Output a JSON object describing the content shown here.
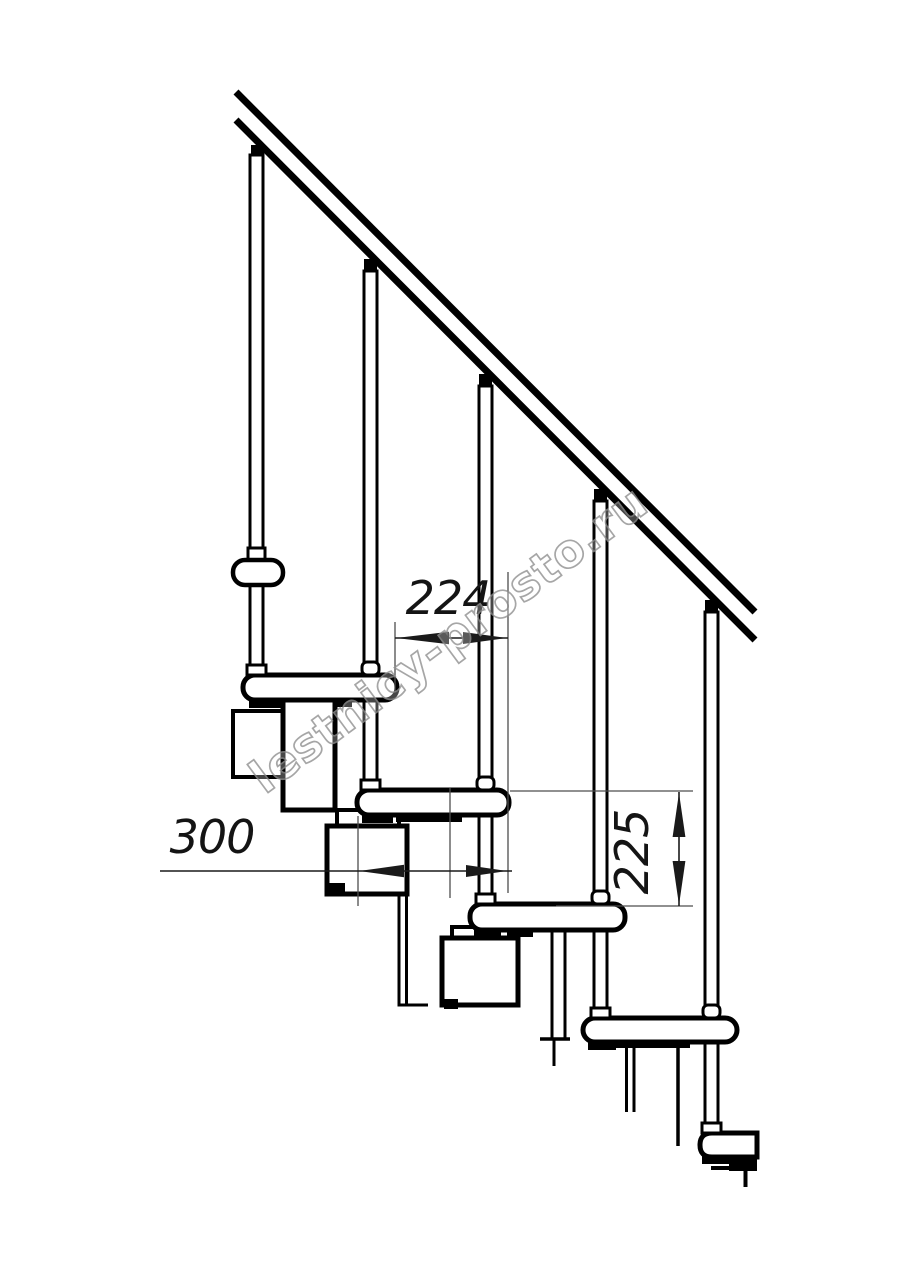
{
  "drawing": {
    "title": "modular-staircase-side-elevation",
    "background": "#ffffff",
    "line_color": "#000000",
    "thin_line_color": "#4d4d4d",
    "watermark": {
      "text": "lestnicy-prosto.ru",
      "color": "#909090"
    },
    "dimensions": {
      "going": {
        "label": "224"
      },
      "tread_length": {
        "label": "300"
      },
      "rise": {
        "label": "225"
      }
    },
    "parts": {
      "treads_count": "5",
      "balusters_count": "5"
    }
  }
}
